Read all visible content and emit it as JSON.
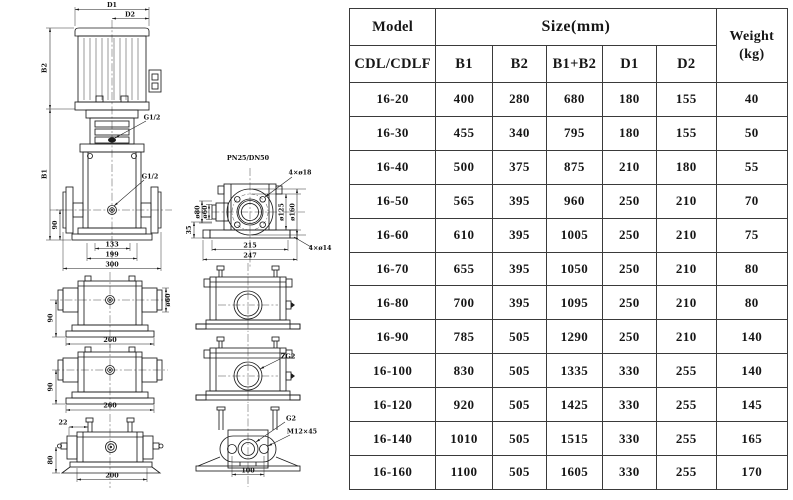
{
  "table": {
    "header": {
      "model": "Model",
      "model_sub": "CDL/CDLF",
      "size_group": "Size(mm)",
      "size_cols": [
        "B1",
        "B2",
        "B1+B2",
        "D1",
        "D2"
      ],
      "weight_line1": "Weight",
      "weight_line2": "(kg)"
    },
    "rows": [
      {
        "model": "16-20",
        "b1": "400",
        "b2": "280",
        "b1b2": "680",
        "d1": "180",
        "d2": "155",
        "weight": "40"
      },
      {
        "model": "16-30",
        "b1": "455",
        "b2": "340",
        "b1b2": "795",
        "d1": "180",
        "d2": "155",
        "weight": "50"
      },
      {
        "model": "16-40",
        "b1": "500",
        "b2": "375",
        "b1b2": "875",
        "d1": "210",
        "d2": "180",
        "weight": "55"
      },
      {
        "model": "16-50",
        "b1": "565",
        "b2": "395",
        "b1b2": "960",
        "d1": "250",
        "d2": "210",
        "weight": "70"
      },
      {
        "model": "16-60",
        "b1": "610",
        "b2": "395",
        "b1b2": "1005",
        "d1": "250",
        "d2": "210",
        "weight": "75"
      },
      {
        "model": "16-70",
        "b1": "655",
        "b2": "395",
        "b1b2": "1050",
        "d1": "250",
        "d2": "210",
        "weight": "80"
      },
      {
        "model": "16-80",
        "b1": "700",
        "b2": "395",
        "b1b2": "1095",
        "d1": "250",
        "d2": "210",
        "weight": "80"
      },
      {
        "model": "16-90",
        "b1": "785",
        "b2": "505",
        "b1b2": "1290",
        "d1": "250",
        "d2": "210",
        "weight": "140"
      },
      {
        "model": "16-100",
        "b1": "830",
        "b2": "505",
        "b1b2": "1335",
        "d1": "330",
        "d2": "255",
        "weight": "140"
      },
      {
        "model": "16-120",
        "b1": "920",
        "b2": "505",
        "b1b2": "1425",
        "d1": "330",
        "d2": "255",
        "weight": "145"
      },
      {
        "model": "16-140",
        "b1": "1010",
        "b2": "505",
        "b1b2": "1515",
        "d1": "330",
        "d2": "255",
        "weight": "165"
      },
      {
        "model": "16-160",
        "b1": "1100",
        "b2": "505",
        "b1b2": "1605",
        "d1": "330",
        "d2": "255",
        "weight": "170"
      }
    ]
  },
  "drawing": {
    "labels": {
      "d1": "D1",
      "d2": "D2",
      "b1": "B1",
      "b2": "B2",
      "g12_a": "G1/2",
      "g12_b": "G1/2",
      "dim90": "90",
      "dim133": "133",
      "dim199": "199",
      "dim300": "300",
      "flange_title": "PN25/DN50",
      "bolt4x18": "4×ø18",
      "bolt4x14": "4×ø14",
      "dia125": "ø125",
      "dia160": "ø160",
      "dia80": "ø80",
      "dia60": "ø60",
      "dim35": "35",
      "dim215": "215",
      "dim247": "247",
      "dia60_side": "ø60",
      "dim90_s1": "90",
      "dim260_s1": "260",
      "dim90_s2": "90",
      "dim260_s2": "260",
      "dim22": "22",
      "dim80": "80",
      "dim200": "200",
      "zg2": "ZG2",
      "g2": "G2",
      "m12x45": "M12×45",
      "dim100": "100"
    }
  },
  "colors": {
    "line": "#1c1c1c",
    "table_border": "#3a3a3a",
    "text": "#161616",
    "background": "#ffffff"
  }
}
